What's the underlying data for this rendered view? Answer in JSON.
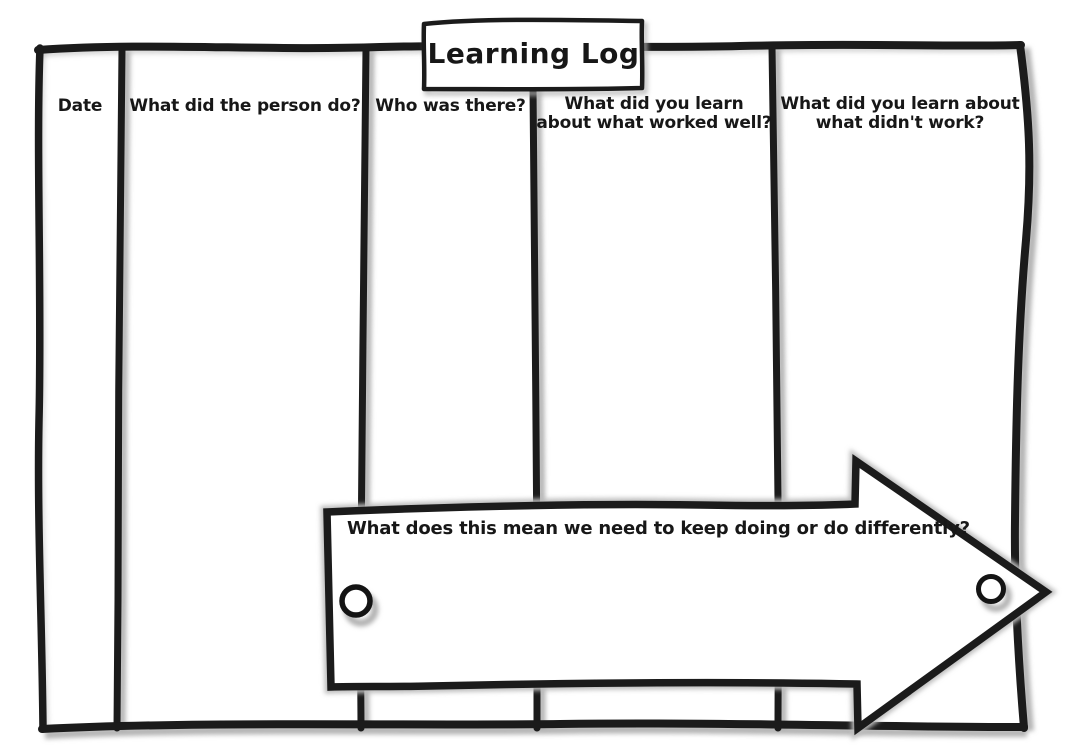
{
  "title": "Learning Log",
  "columns": [
    {
      "label": "Date"
    },
    {
      "label": "What did the person do?"
    },
    {
      "label": "Who was there?"
    },
    {
      "label": "What did you learn\nabout what worked well?"
    },
    {
      "label": "What did you learn about\nwhat didn't work?"
    }
  ],
  "arrow": {
    "label": "What does this mean we need to keep doing or do differently?"
  },
  "icons": {
    "pin_hole_left": "circle-pin-hole",
    "pin_hole_right": "circle-pin-hole"
  },
  "colors": {
    "ink": "#1b1b1b",
    "paper": "#ffffff",
    "shadow": "#b3b3b3"
  }
}
